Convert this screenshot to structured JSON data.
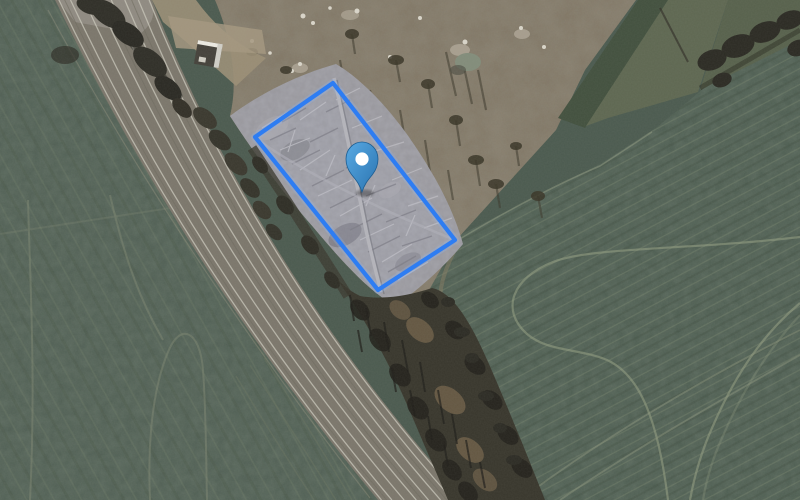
{
  "map": {
    "type": "satellite"
  },
  "parcel": {
    "points": "333,83 455,240 378,290 255,137",
    "stroke_color": "#2e7df2",
    "glow_color": "#8ab4f8",
    "fill_color": "rgba(205,218,238,0.08)"
  },
  "marker": {
    "transform": "translate(362,192)",
    "color_top": "#58a9e3",
    "color_bottom": "#2b74b0",
    "outline_color": "#1d5d92",
    "dot_color": "#ffffff"
  }
}
